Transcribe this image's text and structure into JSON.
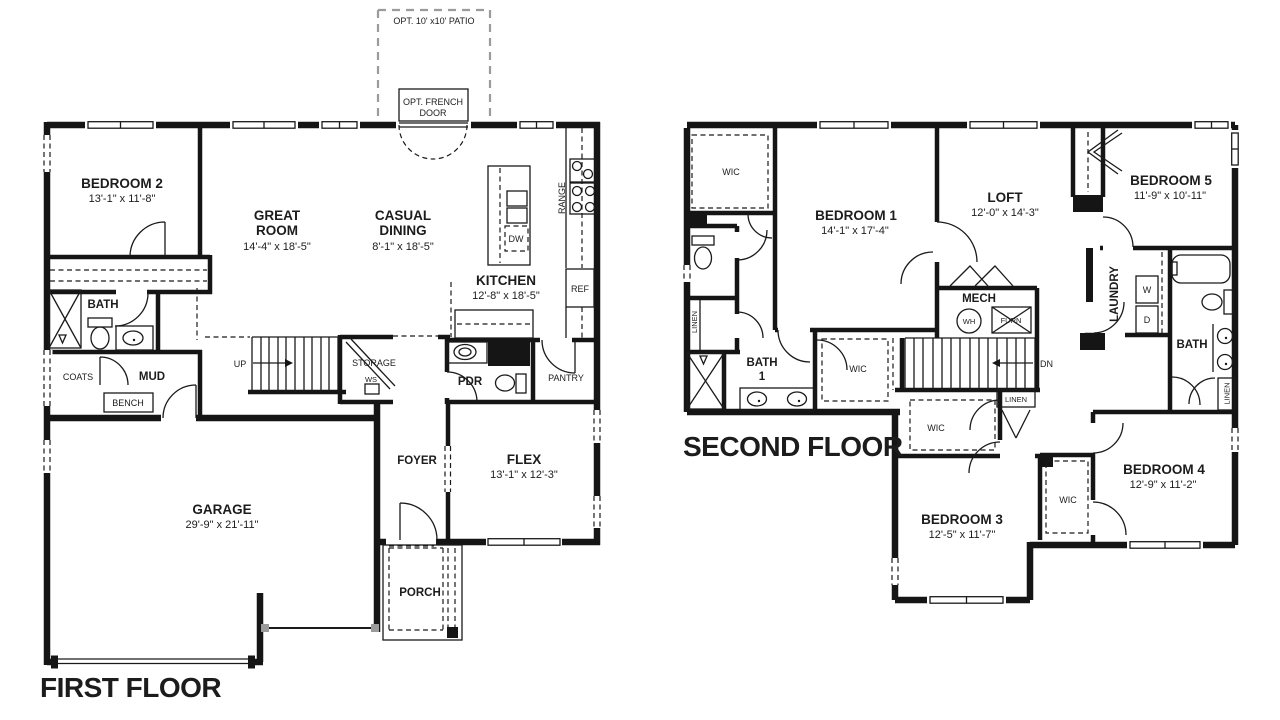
{
  "colors": {
    "wall": "#151515",
    "optional_dash": "#9b9b9b",
    "background": "#ffffff"
  },
  "ff": {
    "title": "FIRST FLOOR",
    "patio": "OPT. 10' x10' PATIO",
    "french1": "OPT. FRENCH",
    "french2": "DOOR",
    "bedroom2": {
      "name": "BEDROOM 2",
      "dims": "13'-1\" x 11'-8\""
    },
    "great": {
      "l1": "GREAT",
      "l2": "ROOM",
      "dims": "14'-4\" x 18'-5\""
    },
    "dining": {
      "l1": "CASUAL",
      "l2": "DINING",
      "dims": "8'-1\" x 18'-5\""
    },
    "kitchen": {
      "name": "KITCHEN",
      "dims": "12'-8\" x 18'-5\""
    },
    "flex": {
      "name": "FLEX",
      "dims": "13'-1\" x 12'-3\""
    },
    "garage": {
      "name": "GARAGE",
      "dims": "29'-9\" x 21'-11\""
    },
    "bath": "BATH",
    "mud": "MUD",
    "pdr": "PDR",
    "foyer": "FOYER",
    "porch": "PORCH",
    "coats": "COATS",
    "bench": "BENCH",
    "up": "UP",
    "storage": "STORAGE",
    "ws": "WS",
    "pantry": "PANTRY",
    "range": "RANGE",
    "ref": "REF",
    "dw": "DW"
  },
  "sf": {
    "title": "SECOND FLOOR",
    "bedroom1": {
      "name": "BEDROOM 1",
      "dims": "14'-1\" x 17'-4\""
    },
    "loft": {
      "name": "LOFT",
      "dims": "12'-0\" x 14'-3\""
    },
    "bedroom3": {
      "name": "BEDROOM 3",
      "dims": "12'-5\" x 11'-7\""
    },
    "bedroom4": {
      "name": "BEDROOM 4",
      "dims": "12'-9\" x 11'-2\""
    },
    "bedroom5": {
      "name": "BEDROOM 5",
      "dims": "11'-9\" x 10'-11\""
    },
    "bath1": {
      "l1": "BATH",
      "l2": "1"
    },
    "bath": "BATH",
    "mech": "MECH",
    "laundry": "LAUNDRY",
    "wic": "WIC",
    "linen": "LINEN",
    "dn": "DN",
    "wh": "WH",
    "furn": "FURN",
    "w": "W",
    "d": "D"
  }
}
